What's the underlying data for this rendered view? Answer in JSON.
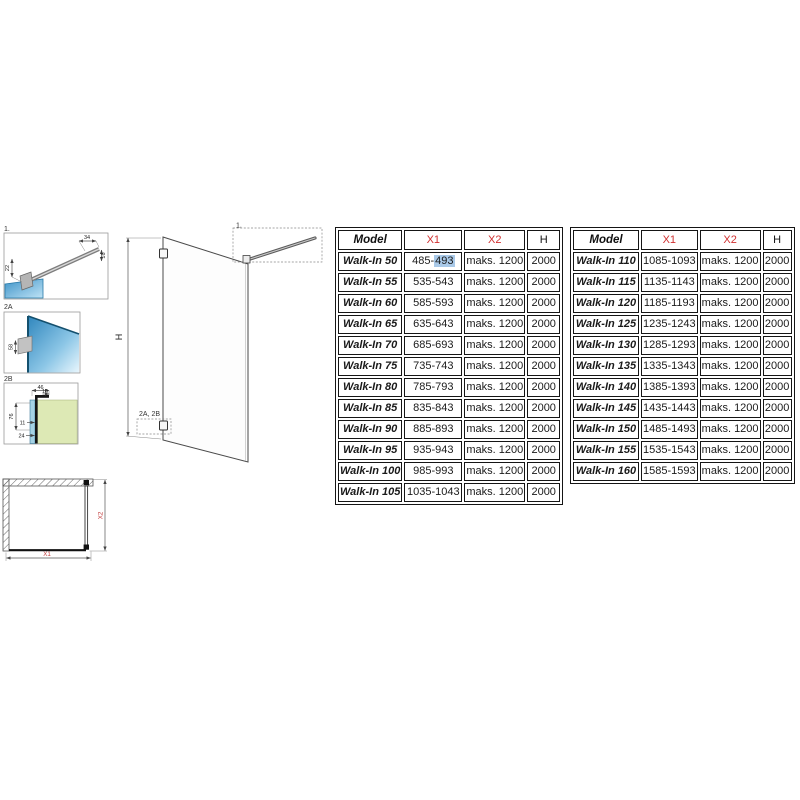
{
  "colors": {
    "header_red": "#d03030",
    "dim_red": "#c23b3b",
    "selection_blue": "#a9c9e8",
    "glass_blue": "#3d93c8",
    "glass_light": "#bfe3f5",
    "wall_green": "#dde9b5",
    "line_dark": "#151515"
  },
  "diagram": {
    "details": {
      "d1": {
        "label": "1.",
        "dim_top": "34",
        "dim_right": "16",
        "dim_left": "22"
      },
      "d2a": {
        "label": "2A",
        "dim": "58"
      },
      "d2b": {
        "label": "2B",
        "dim_width": "46",
        "dim_offset": "10",
        "dim_height": "76",
        "dim_mid": "11",
        "dim_low": "24"
      }
    },
    "elevation": {
      "dim_height": "H",
      "ref_top": "1.",
      "ref_bottom": "2A, 2B"
    },
    "plan": {
      "dim_width": "X1",
      "dim_depth": "X2"
    }
  },
  "tables": [
    {
      "headers": [
        {
          "label": "Model",
          "color": "#111111"
        },
        {
          "label": "X1",
          "color": "#d03030"
        },
        {
          "label": "X2",
          "color": "#d03030"
        },
        {
          "label": "H",
          "color": "#111111"
        }
      ],
      "rows": [
        [
          "Walk-In 50",
          {
            "parts": [
              {
                "t": "485-"
              },
              {
                "t": "493",
                "hl": true
              }
            ]
          },
          "maks. 1200",
          "2000"
        ],
        [
          "Walk-In 55",
          "535-543",
          "maks. 1200",
          "2000"
        ],
        [
          "Walk-In 60",
          "585-593",
          "maks. 1200",
          "2000"
        ],
        [
          "Walk-In 65",
          "635-643",
          "maks. 1200",
          "2000"
        ],
        [
          "Walk-In 70",
          "685-693",
          "maks. 1200",
          "2000"
        ],
        [
          "Walk-In 75",
          "735-743",
          "maks. 1200",
          "2000"
        ],
        [
          "Walk-In 80",
          "785-793",
          "maks. 1200",
          "2000"
        ],
        [
          "Walk-In 85",
          "835-843",
          "maks. 1200",
          "2000"
        ],
        [
          "Walk-In 90",
          "885-893",
          "maks. 1200",
          "2000"
        ],
        [
          "Walk-In 95",
          "935-943",
          "maks. 1200",
          "2000"
        ],
        [
          "Walk-In 100",
          "985-993",
          "maks. 1200",
          "2000"
        ],
        [
          "Walk-In 105",
          "1035-1043",
          "maks. 1200",
          "2000"
        ]
      ]
    },
    {
      "headers": [
        {
          "label": "Model",
          "color": "#111111"
        },
        {
          "label": "X1",
          "color": "#d03030"
        },
        {
          "label": "X2",
          "color": "#d03030"
        },
        {
          "label": "H",
          "color": "#111111"
        }
      ],
      "rows": [
        [
          "Walk-In 110",
          "1085-1093",
          "maks. 1200",
          "2000"
        ],
        [
          "Walk-In 115",
          "1135-1143",
          "maks. 1200",
          "2000"
        ],
        [
          "Walk-In 120",
          "1185-1193",
          "maks. 1200",
          "2000"
        ],
        [
          "Walk-In 125",
          "1235-1243",
          "maks. 1200",
          "2000"
        ],
        [
          "Walk-In 130",
          "1285-1293",
          "maks. 1200",
          "2000"
        ],
        [
          "Walk-In 135",
          "1335-1343",
          "maks. 1200",
          "2000"
        ],
        [
          "Walk-In 140",
          "1385-1393",
          "maks. 1200",
          "2000"
        ],
        [
          "Walk-In 145",
          "1435-1443",
          "maks. 1200",
          "2000"
        ],
        [
          "Walk-In 150",
          "1485-1493",
          "maks. 1200",
          "2000"
        ],
        [
          "Walk-In 155",
          "1535-1543",
          "maks. 1200",
          "2000"
        ],
        [
          "Walk-In 160",
          "1585-1593",
          "maks. 1200",
          "2000"
        ]
      ]
    }
  ]
}
